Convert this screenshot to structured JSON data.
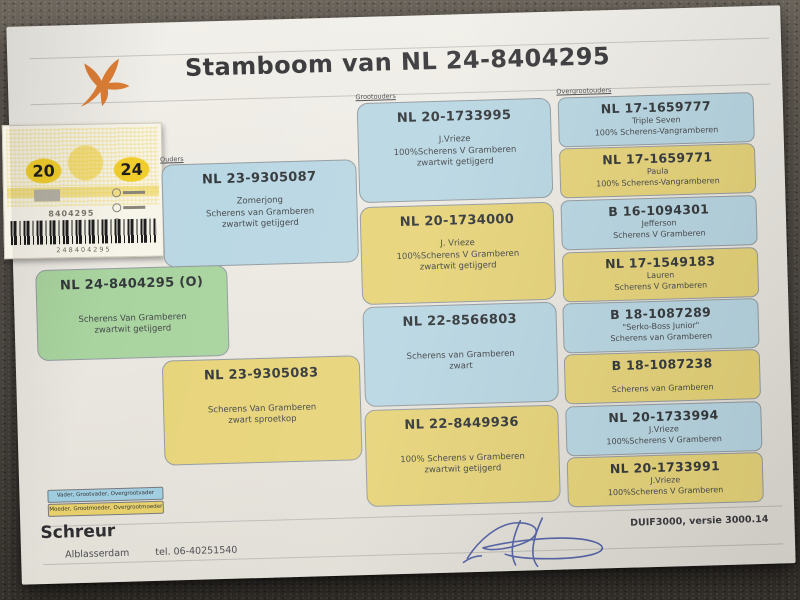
{
  "title": "Stamboom van NL 24-8404295",
  "ring_card": {
    "year_left": "20",
    "year_right": "24",
    "ring_number": "8404295",
    "barcode_number": "248404295"
  },
  "columns": {
    "parents": "Ouders",
    "grandparents": "Grootouders",
    "greatgrandparents": "Overgrootouders"
  },
  "pedigree": {
    "subject": {
      "ring": "NL 24-8404295 (O)",
      "line1": "",
      "line2": "Scherens Van Gramberen",
      "line3": "zwartwit getijgerd"
    },
    "father": {
      "ring": "NL 23-9305087",
      "line1": "Zomerjong",
      "line2": "Scherens van Gramberen",
      "line3": "zwartwit getijgerd"
    },
    "mother": {
      "ring": "NL 23-9305083",
      "line1": "",
      "line2": "Scherens Van Gramberen",
      "line3": "zwart sproetkop"
    },
    "grandparents": [
      {
        "ring": "NL 20-1733995",
        "line1": "J.Vrieze",
        "line2": "100%Scherens V Gramberen",
        "line3": "zwartwit getijgerd"
      },
      {
        "ring": "NL 20-1734000",
        "line1": "J. Vrieze",
        "line2": "100%Scherens V Gramberen",
        "line3": "zwartwit getijgerd"
      },
      {
        "ring": "NL 22-8566803",
        "line1": "",
        "line2": "Scherens van Gramberen",
        "line3": "zwart"
      },
      {
        "ring": "NL 22-8449936",
        "line1": "",
        "line2": "100% Scherens v Gramberen",
        "line3": "zwartwit getijgerd"
      }
    ],
    "greatgrandparents": [
      {
        "ring": "NL 17-1659777",
        "line1": "Triple Seven",
        "line2": "100% Scherens-Vangramberen"
      },
      {
        "ring": "NL 17-1659771",
        "line1": "Paula",
        "line2": "100% Scherens-Vangramberen"
      },
      {
        "ring": "B 16-1094301",
        "line1": "Jefferson",
        "line2": "Scherens V Gramberen"
      },
      {
        "ring": "NL 17-1549183",
        "line1": "Lauren",
        "line2": "Scherens V Gramberen"
      },
      {
        "ring": "B 18-1087289",
        "line1": "\"Serko-Boss Junior\"",
        "line2": "Scherens van Gramberen"
      },
      {
        "ring": "B 18-1087238",
        "line1": "",
        "line2": "Scherens van Gramberen"
      },
      {
        "ring": "NL 20-1733994",
        "line1": "J.Vrieze",
        "line2": "100%Scherens V Gramberen"
      },
      {
        "ring": "NL 20-1733991",
        "line1": "J.Vrieze",
        "line2": "100%Scherens V Gramberen"
      }
    ]
  },
  "legend": {
    "male": "Vader, Grootvader, Overgrootvader",
    "female": "Moeder, Grootmoeder, Overgrootmoeder"
  },
  "footer": {
    "name": "Schreur",
    "city": "Alblasserdam",
    "phone": "tel. 06-40251540",
    "software": "DUIF3000, versie 3000.14"
  },
  "colors": {
    "male_box": "#b9d7e3",
    "female_box": "#e7d47a",
    "subject_box": "#a9d49f",
    "logo_orange": "#dd7e36",
    "ink_blue": "#3b4d9e"
  }
}
